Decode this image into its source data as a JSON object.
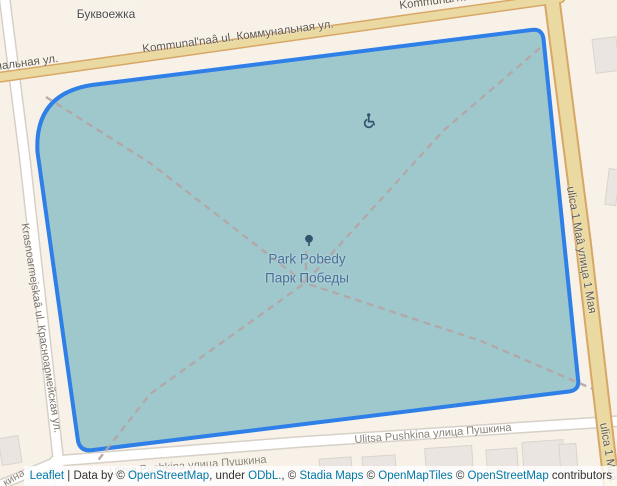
{
  "map": {
    "poi": {
      "bukvoezhka_line1": "Bukvoežka",
      "bukvoezhka_line2": "Буквоежка"
    },
    "park": {
      "name_latin": "Park Pobedy",
      "name_cyrillic": "Парк Победы",
      "tree_icon": "tree-icon",
      "wheelchair_icon": "wheelchair-icon"
    },
    "streets": {
      "kommunalnaya": "Kommunal'naâ ul. Коммунальная ул.",
      "kommunalnaya_partial_left": "нальная ул.",
      "kommunalnaya_partial_top": "Kommunal'naâ ul.",
      "krasnoarmeyskaya": "Krasnoarmejskaâ ul. Красноармейская ул.",
      "ulitsa_1_maya": "ulica 1 Maâ улица 1 Мая",
      "ulitsa_1_maya_partial": "ulica 1 Maâ",
      "pushkina": "Ulitsa Pushkina улица Пушкина",
      "pushkina_partial": "Ulitsa Pushkina улица Пушкина",
      "pushkina_corner": "кина"
    }
  },
  "colors": {
    "land": "#f7f1e8",
    "park_fill": "#9fc8cd",
    "park_border": "#2e7fe8",
    "road_tan_fill": "#ead9a1",
    "road_tan_casing": "#d8a766",
    "road_white_fill": "#ffffff",
    "road_white_casing": "#d6d0c7",
    "building_fill": "#eae5e0",
    "building_stroke": "#dad4cd",
    "path_dash": "#b5a5a5",
    "park_label": "#4b6e96",
    "icon_dark": "#33546e",
    "link_blue": "#0078a8"
  },
  "attribution": {
    "segments": [
      {
        "text": "Leaflet",
        "type": "link"
      },
      {
        "text": " | ",
        "type": "text"
      },
      {
        "text": "Data by ",
        "type": "text"
      },
      {
        "text": "© ",
        "type": "text"
      },
      {
        "text": "OpenStreetMap",
        "type": "link"
      },
      {
        "text": ", under ",
        "type": "text"
      },
      {
        "text": "ODbL.",
        "type": "link"
      },
      {
        "text": ", © ",
        "type": "text"
      },
      {
        "text": "Stadia Maps",
        "type": "link"
      },
      {
        "text": " © ",
        "type": "text"
      },
      {
        "text": "OpenMapTiles",
        "type": "link"
      },
      {
        "text": " © ",
        "type": "text"
      },
      {
        "text": "OpenStreetMap",
        "type": "link"
      },
      {
        "text": " contributors",
        "type": "text"
      }
    ]
  }
}
